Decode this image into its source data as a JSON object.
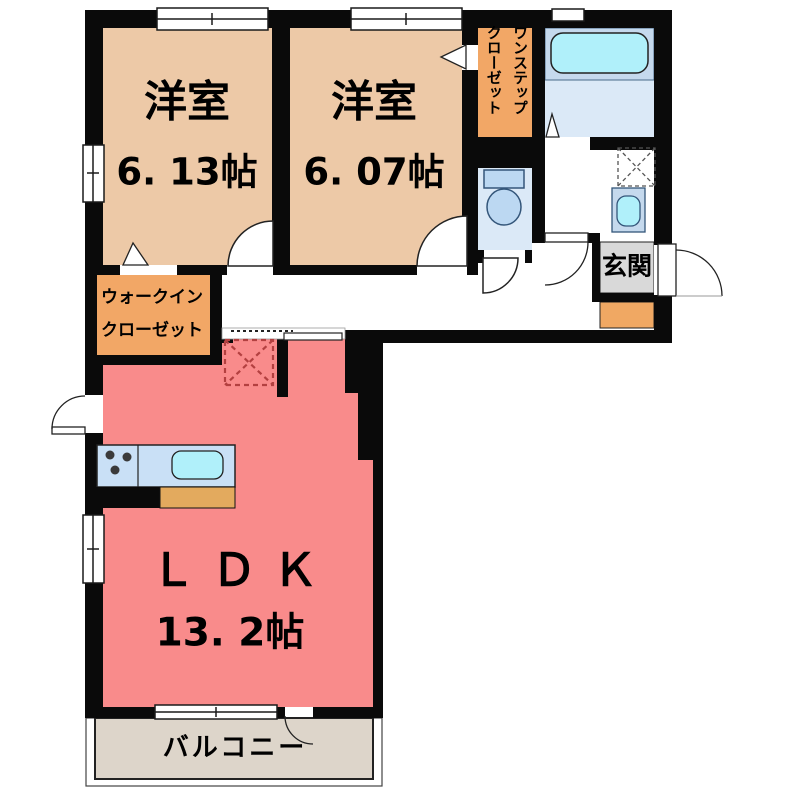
{
  "labels": {
    "bedroom1": {
      "name": "洋室",
      "size": "6. 13帖"
    },
    "bedroom2": {
      "name": "洋室",
      "size": "6. 07帖"
    },
    "ldk": {
      "name": "ＬＤＫ",
      "size": "13. 2帖"
    },
    "walk_in_closet": {
      "line1": "ウォークイン",
      "line2": "クローゼット"
    },
    "one_step_closet": {
      "col_right": "ワンステップ",
      "col_left": "クローゼット"
    },
    "entrance": "玄関",
    "balcony": "バルコニー"
  },
  "colors": {
    "wall": "#0a0a0a",
    "bedroom_floor": "#edc9a7",
    "closet_fill": "#f2a766",
    "ldk_floor": "#f98b8b",
    "wet_area_floor": "#dbe9f7",
    "tub_zone": "#c5d9ed",
    "bathtub": "#b0f0fa",
    "kitchen_counter": "#c9e0f6",
    "counter_top": "#e3aa5e",
    "entrance_tile": "#d9d9d9",
    "shoe_cabinet": "#f0a863",
    "balcony_floor": "#ddd5ca",
    "appliance_dash": "#b34040",
    "fixture_fill": "#bcd8f2"
  }
}
